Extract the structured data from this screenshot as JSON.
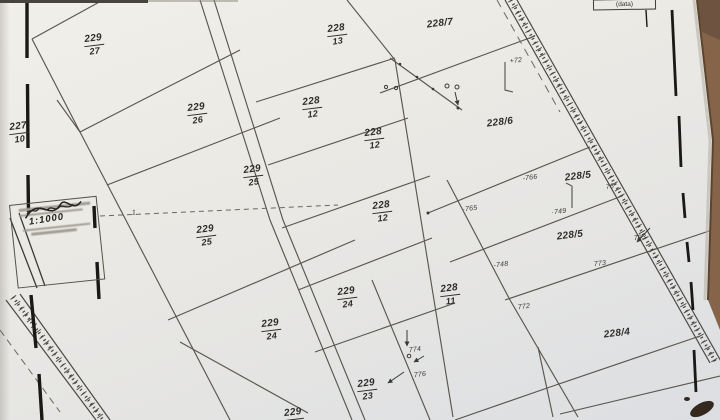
{
  "document": {
    "type": "cadastral-parcel-map-photo",
    "sheet_region": "parcels 227, 228, 229 with subdivisions"
  },
  "corner_box": {
    "label": "(data)"
  },
  "stamp": {
    "scale": "1:1000"
  },
  "parcel_labels": [
    {
      "text": "229/27",
      "style": "fraction",
      "x": 94,
      "y": 45
    },
    {
      "text": "227/10",
      "style": "fraction",
      "x": 19,
      "y": 133
    },
    {
      "text": "229/26",
      "style": "fraction",
      "x": 197,
      "y": 114
    },
    {
      "text": "229/25",
      "style": "fraction",
      "x": 253,
      "y": 176
    },
    {
      "text": "229/25",
      "style": "fraction",
      "x": 206,
      "y": 236
    },
    {
      "text": "229/24",
      "style": "fraction",
      "x": 347,
      "y": 298
    },
    {
      "text": "229/24",
      "style": "fraction",
      "x": 271,
      "y": 330
    },
    {
      "text": "229/23",
      "style": "fraction",
      "x": 367,
      "y": 390
    },
    {
      "text": "229",
      "style": "fraction",
      "x": 293,
      "y": 414
    },
    {
      "text": "228/13",
      "style": "fraction",
      "x": 337,
      "y": 35
    },
    {
      "text": "228/12",
      "style": "fraction",
      "x": 312,
      "y": 108
    },
    {
      "text": "228/12",
      "style": "fraction",
      "x": 374,
      "y": 139
    },
    {
      "text": "228/12",
      "style": "fraction",
      "x": 382,
      "y": 212
    },
    {
      "text": "228/11",
      "style": "fraction",
      "x": 450,
      "y": 295
    },
    {
      "text": "228/7",
      "style": "slash",
      "x": 440,
      "y": 24
    },
    {
      "text": "228/6",
      "style": "slash",
      "x": 500,
      "y": 123
    },
    {
      "text": "228/5",
      "style": "slash",
      "x": 578,
      "y": 177
    },
    {
      "text": "228/5",
      "style": "slash",
      "x": 570,
      "y": 236
    },
    {
      "text": "228/4",
      "style": "slash",
      "x": 617,
      "y": 334
    }
  ],
  "measure_labels": [
    {
      "text": "+72",
      "x": 516,
      "y": 61
    },
    {
      "text": "-766",
      "x": 530,
      "y": 178
    },
    {
      "text": "·765",
      "x": 470,
      "y": 209
    },
    {
      "text": "·749",
      "x": 559,
      "y": 212
    },
    {
      "text": "-748",
      "x": 501,
      "y": 265
    },
    {
      "text": "772",
      "x": 524,
      "y": 307
    },
    {
      "text": "773",
      "x": 600,
      "y": 264
    },
    {
      "text": "774",
      "x": 415,
      "y": 350
    },
    {
      "text": "776",
      "x": 420,
      "y": 375
    },
    {
      "text": "723",
      "x": 640,
      "y": 238
    },
    {
      "text": "76",
      "x": 610,
      "y": 187
    },
    {
      "text": "1",
      "x": 134,
      "y": 213
    }
  ],
  "colors": {
    "paper": "#ebe9e4",
    "boundary_line": "#5a564f",
    "border_mark": "#1a1916",
    "label_ink": "#2f2d29",
    "table_wood": "#85644a",
    "smudge": "#35291d"
  }
}
